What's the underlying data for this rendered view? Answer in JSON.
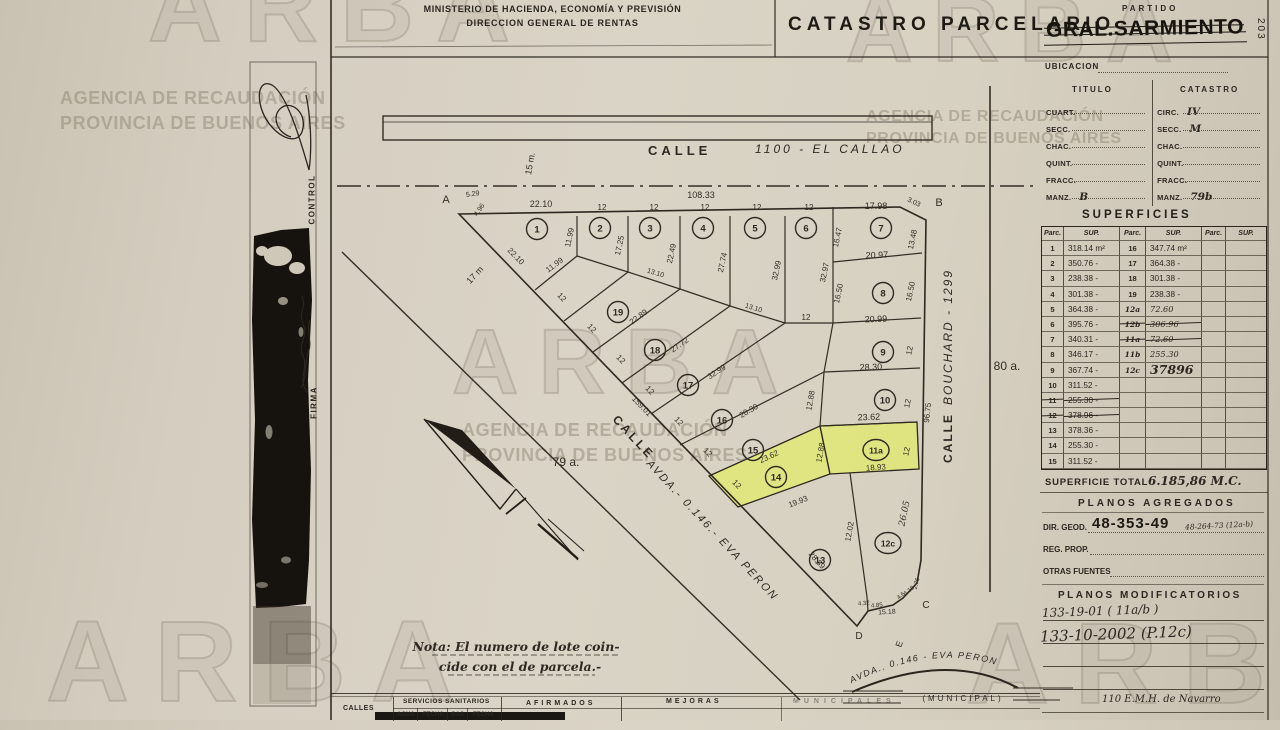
{
  "watermark": {
    "brand": "ARBA",
    "line1": "AGENCIA DE RECAUDACIÓN",
    "line2": "PROVINCIA DE BUENOS AIRES"
  },
  "header": {
    "ministry1": "MINISTERIO DE HACIENDA, ECONOMÍA Y PREVISIÓN",
    "ministry2": "DIRECCION GENERAL DE RENTAS",
    "title": "CATASTRO PARCELARIO",
    "partido_label": "PARTIDO",
    "partido_value": "GRAL.SARMIENTO",
    "page_number": "203"
  },
  "sidebar": {
    "control": "CONTROL",
    "firma": "FIRMA"
  },
  "ubicacion": {
    "title": "UBICACION",
    "col1": "TITULO",
    "col2": "CATASTRO",
    "rows": [
      {
        "l": "CUART.",
        "lv": "",
        "r": "CIRC.",
        "rv": "IV"
      },
      {
        "l": "SECC.",
        "lv": "",
        "r": "SECC.",
        "rv": "M"
      },
      {
        "l": "CHAC.",
        "lv": "",
        "r": "CHAC.",
        "rv": ""
      },
      {
        "l": "QUINT.",
        "lv": "",
        "r": "QUINT.",
        "rv": ""
      },
      {
        "l": "FRACC.",
        "lv": "",
        "r": "FRACC.",
        "rv": ""
      },
      {
        "l": "MANZ.",
        "lv": "B",
        "r": "MANZ.",
        "rv": "79b"
      }
    ]
  },
  "superficies": {
    "title": "SUPERFICIES",
    "parc_header": "Parc.",
    "sup_header": "SUP.",
    "rows": [
      {
        "p1": "1",
        "s1": "318.14 m²",
        "p2": "16",
        "s2": "347.74 m²"
      },
      {
        "p1": "2",
        "s1": "350.76 -",
        "p2": "17",
        "s2": "364.38 -"
      },
      {
        "p1": "3",
        "s1": "238.38 -",
        "p2": "18",
        "s2": "301.38 -"
      },
      {
        "p1": "4",
        "s1": "301.38 -",
        "p2": "19",
        "s2": "238.38 -"
      },
      {
        "p1": "5",
        "s1": "364.38 -",
        "p2": "12a",
        "s2": "72.60",
        "h2": true
      },
      {
        "p1": "6",
        "s1": "395.76 -",
        "p2": "12b",
        "s2": "306.96",
        "h2": true,
        "strike2": true
      },
      {
        "p1": "7",
        "s1": "340.31 -",
        "p2": "11a",
        "s2": "72.60",
        "h2": true,
        "strike2": true
      },
      {
        "p1": "8",
        "s1": "346.17 -",
        "p2": "11b",
        "s2": "255.30",
        "h2": true
      },
      {
        "p1": "9",
        "s1": "367.74 -",
        "p2": "12c",
        "s2": "37896",
        "h2": true,
        "big2": true
      },
      {
        "p1": "10",
        "s1": "311.52 -"
      },
      {
        "p1": "11",
        "s1": "255.30 -",
        "strike1": true
      },
      {
        "p1": "12",
        "s1": "378.96 -",
        "strike1": true
      },
      {
        "p1": "13",
        "s1": "378.36 -"
      },
      {
        "p1": "14",
        "s1": "255.30 -"
      },
      {
        "p1": "15",
        "s1": "311.52 -"
      }
    ],
    "total_label": "SUPERFICIE TOTAL",
    "total_value": "6.185,86 M.C."
  },
  "planos_agregados": {
    "title": "PLANOS AGREGADOS",
    "dir_geod_label": "DIR. GEOD.",
    "dir_geod_value": "48-353-49",
    "dir_geod_hand": "48-264-73 (12a-b)",
    "reg_prop_label": "REG. PROP.",
    "otras_label": "OTRAS FUENTES"
  },
  "planos_modificatorios": {
    "title": "PLANOS MODIFICATORIOS",
    "entry1": "133-19-01 ( 11a/b )",
    "entry2": "133-10-2002 (P.12c)",
    "footer": "110 E.M.H. de Navarro"
  },
  "bottom_table": {
    "calles": "CALLES",
    "servicios": "SERVICIOS SANITARIOS",
    "agua": "AGUA",
    "fecha1": "FECHA",
    "gas": "GAS",
    "fecha2": "FECHA",
    "afirmados": "AFIRMADOS",
    "mejoras": "MEJORAS",
    "municipales": "MUNICIPALES"
  },
  "map": {
    "calle_top_a": "CALLE",
    "calle_top_b": "1100 -   EL CALLAO",
    "calle_top_width": "15 m.",
    "calle_right_a": "CALLE",
    "calle_right_b": "BOUCHARD  - 1299",
    "avda_calle": "CALLE",
    "avda": "AVDA.-  0.146.-  EVA  PERON",
    "avda_arc": "AVDA.. 0.146 -  EVA  PERON",
    "municipal": "(MUNICIPAL)",
    "note1": "Nota: El numero de lote coin-",
    "note2": "cide con el de parcela.-",
    "labels": [
      {
        "t": "A",
        "x": 446,
        "y": 203,
        "r": 0,
        "s": 11
      },
      {
        "t": "B",
        "x": 939,
        "y": 206,
        "r": 0,
        "s": 11
      },
      {
        "t": "C",
        "x": 926,
        "y": 608,
        "r": 0,
        "s": 10
      },
      {
        "t": "D",
        "x": 859,
        "y": 639,
        "r": 0,
        "s": 10
      },
      {
        "t": "E",
        "x": 902,
        "y": 645,
        "r": -70,
        "s": 9
      },
      {
        "t": "5.29",
        "x": 473,
        "y": 196,
        "r": -8,
        "s": 7
      },
      {
        "t": "4.96",
        "x": 481,
        "y": 211,
        "r": -55,
        "s": 7
      },
      {
        "t": "3.03",
        "x": 913,
        "y": 204,
        "r": 25,
        "s": 7
      },
      {
        "t": "108.33",
        "x": 701,
        "y": 198,
        "r": 0,
        "s": 9
      },
      {
        "t": "22.10",
        "x": 541,
        "y": 207,
        "r": 0,
        "s": 9
      },
      {
        "t": "12",
        "x": 602,
        "y": 210,
        "r": 0,
        "s": 8
      },
      {
        "t": "12",
        "x": 654,
        "y": 210,
        "r": 0,
        "s": 8
      },
      {
        "t": "12",
        "x": 705,
        "y": 210,
        "r": 0,
        "s": 8
      },
      {
        "t": "12",
        "x": 757,
        "y": 210,
        "r": 0,
        "s": 8
      },
      {
        "t": "12",
        "x": 809,
        "y": 210,
        "r": 0,
        "s": 8
      },
      {
        "t": "17.98",
        "x": 876,
        "y": 209,
        "r": 0,
        "s": 9
      },
      {
        "t": "11.99",
        "x": 572,
        "y": 238,
        "r": -78,
        "s": 8
      },
      {
        "t": "17.25",
        "x": 622,
        "y": 246,
        "r": -78,
        "s": 8
      },
      {
        "t": "22.49",
        "x": 674,
        "y": 254,
        "r": -78,
        "s": 8
      },
      {
        "t": "27.74",
        "x": 725,
        "y": 263,
        "r": -78,
        "s": 8
      },
      {
        "t": "32.99",
        "x": 779,
        "y": 271,
        "r": -78,
        "s": 8
      },
      {
        "t": "32.97",
        "x": 827,
        "y": 273,
        "r": -78,
        "s": 8
      },
      {
        "t": "16.47",
        "x": 840,
        "y": 238,
        "r": -78,
        "s": 8
      },
      {
        "t": "13.48",
        "x": 915,
        "y": 240,
        "r": -78,
        "s": 8
      },
      {
        "t": "20.97",
        "x": 877,
        "y": 258,
        "r": -2,
        "s": 9
      },
      {
        "t": "16.50",
        "x": 841,
        "y": 294,
        "r": -78,
        "s": 8
      },
      {
        "t": "16.50",
        "x": 913,
        "y": 292,
        "r": -78,
        "s": 8
      },
      {
        "t": "20.99",
        "x": 876,
        "y": 322,
        "r": -2,
        "s": 9
      },
      {
        "t": "12",
        "x": 806,
        "y": 320,
        "r": 0,
        "s": 8
      },
      {
        "t": "12",
        "x": 912,
        "y": 351,
        "r": -78,
        "s": 8
      },
      {
        "t": "28.30",
        "x": 871,
        "y": 370,
        "r": -2,
        "s": 9
      },
      {
        "t": "12",
        "x": 910,
        "y": 404,
        "r": -78,
        "s": 8
      },
      {
        "t": "23.62",
        "x": 869,
        "y": 420,
        "r": -2,
        "s": 9
      },
      {
        "t": "12",
        "x": 909,
        "y": 452,
        "r": -78,
        "s": 8
      },
      {
        "t": "18.93",
        "x": 876,
        "y": 470,
        "r": -4,
        "s": 8
      },
      {
        "t": "12.88",
        "x": 813,
        "y": 401,
        "r": -80,
        "s": 8
      },
      {
        "t": "12.88",
        "x": 823,
        "y": 453,
        "r": -80,
        "s": 8
      },
      {
        "t": "96.75",
        "x": 930,
        "y": 413,
        "r": -84,
        "s": 8
      },
      {
        "t": "26.05",
        "x": 907,
        "y": 514,
        "r": -78,
        "s": 9,
        "c": "hnd"
      },
      {
        "t": "12.02",
        "x": 852,
        "y": 532,
        "r": -80,
        "s": 8
      },
      {
        "t": "19.93",
        "x": 799,
        "y": 504,
        "r": -21,
        "s": 8
      },
      {
        "t": "23.62",
        "x": 770,
        "y": 459,
        "r": -25,
        "s": 8
      },
      {
        "t": "28.30",
        "x": 750,
        "y": 413,
        "r": -30,
        "s": 8
      },
      {
        "t": "32.99",
        "x": 718,
        "y": 374,
        "r": -33,
        "s": 8
      },
      {
        "t": "27.72",
        "x": 681,
        "y": 347,
        "r": -35,
        "s": 8
      },
      {
        "t": "22.89",
        "x": 640,
        "y": 319,
        "r": -36,
        "s": 8
      },
      {
        "t": "13.10",
        "x": 655,
        "y": 275,
        "r": 17,
        "s": 7
      },
      {
        "t": "13.10",
        "x": 753,
        "y": 310,
        "r": 17,
        "s": 7
      },
      {
        "t": "12",
        "x": 560,
        "y": 299,
        "r": 46,
        "s": 8
      },
      {
        "t": "12",
        "x": 590,
        "y": 330,
        "r": 46,
        "s": 8
      },
      {
        "t": "12",
        "x": 619,
        "y": 361,
        "r": 46,
        "s": 8
      },
      {
        "t": "12",
        "x": 648,
        "y": 392,
        "r": 46,
        "s": 8
      },
      {
        "t": "12",
        "x": 677,
        "y": 423,
        "r": 46,
        "s": 8
      },
      {
        "t": "12",
        "x": 706,
        "y": 454,
        "r": 46,
        "s": 8
      },
      {
        "t": "12",
        "x": 735,
        "y": 486,
        "r": 46,
        "s": 8
      },
      {
        "t": "22.10",
        "x": 514,
        "y": 258,
        "r": 46,
        "s": 8
      },
      {
        "t": "11.99",
        "x": 556,
        "y": 267,
        "r": -37,
        "s": 8
      },
      {
        "t": "17 m",
        "x": 477,
        "y": 277,
        "r": -47,
        "s": 9
      },
      {
        "t": "159.01",
        "x": 640,
        "y": 408,
        "r": 46,
        "s": 8
      },
      {
        "t": "28.89",
        "x": 815,
        "y": 562,
        "r": 48,
        "s": 8
      },
      {
        "t": "79 a.",
        "x": 566,
        "y": 466,
        "r": 0,
        "s": 12
      },
      {
        "t": "80 a.",
        "x": 1007,
        "y": 370,
        "r": 0,
        "s": 12
      },
      {
        "t": "15.18",
        "x": 887,
        "y": 614,
        "r": -3,
        "s": 7
      },
      {
        "t": "4.32",
        "x": 864,
        "y": 605,
        "r": -5,
        "s": 6
      },
      {
        "t": "4.85",
        "x": 877,
        "y": 607,
        "r": -5,
        "s": 6
      },
      {
        "t": "4.6",
        "x": 902,
        "y": 597,
        "r": -40,
        "s": 6
      },
      {
        "t": "4.18",
        "x": 910,
        "y": 592,
        "r": -40,
        "s": 6
      },
      {
        "t": "2.76",
        "x": 918,
        "y": 584,
        "r": -75,
        "s": 6
      },
      {
        "t": "15 m.",
        "x": 533,
        "y": 164,
        "r": -80,
        "s": 9
      }
    ],
    "circles": [
      {
        "n": "1",
        "x": 537,
        "y": 229
      },
      {
        "n": "2",
        "x": 600,
        "y": 228
      },
      {
        "n": "3",
        "x": 650,
        "y": 228
      },
      {
        "n": "4",
        "x": 703,
        "y": 228
      },
      {
        "n": "5",
        "x": 755,
        "y": 228
      },
      {
        "n": "6",
        "x": 806,
        "y": 228
      },
      {
        "n": "7",
        "x": 881,
        "y": 228
      },
      {
        "n": "8",
        "x": 883,
        "y": 293
      },
      {
        "n": "9",
        "x": 883,
        "y": 352
      },
      {
        "n": "10",
        "x": 885,
        "y": 400
      },
      {
        "n": "11a",
        "x": 876,
        "y": 450
      },
      {
        "n": "12c",
        "x": 888,
        "y": 543
      },
      {
        "n": "13",
        "x": 820,
        "y": 560
      },
      {
        "n": "14",
        "x": 776,
        "y": 477
      },
      {
        "n": "15",
        "x": 753,
        "y": 450
      },
      {
        "n": "16",
        "x": 722,
        "y": 420
      },
      {
        "n": "17",
        "x": 688,
        "y": 385
      },
      {
        "n": "18",
        "x": 655,
        "y": 350
      },
      {
        "n": "19",
        "x": 618,
        "y": 312
      }
    ]
  }
}
